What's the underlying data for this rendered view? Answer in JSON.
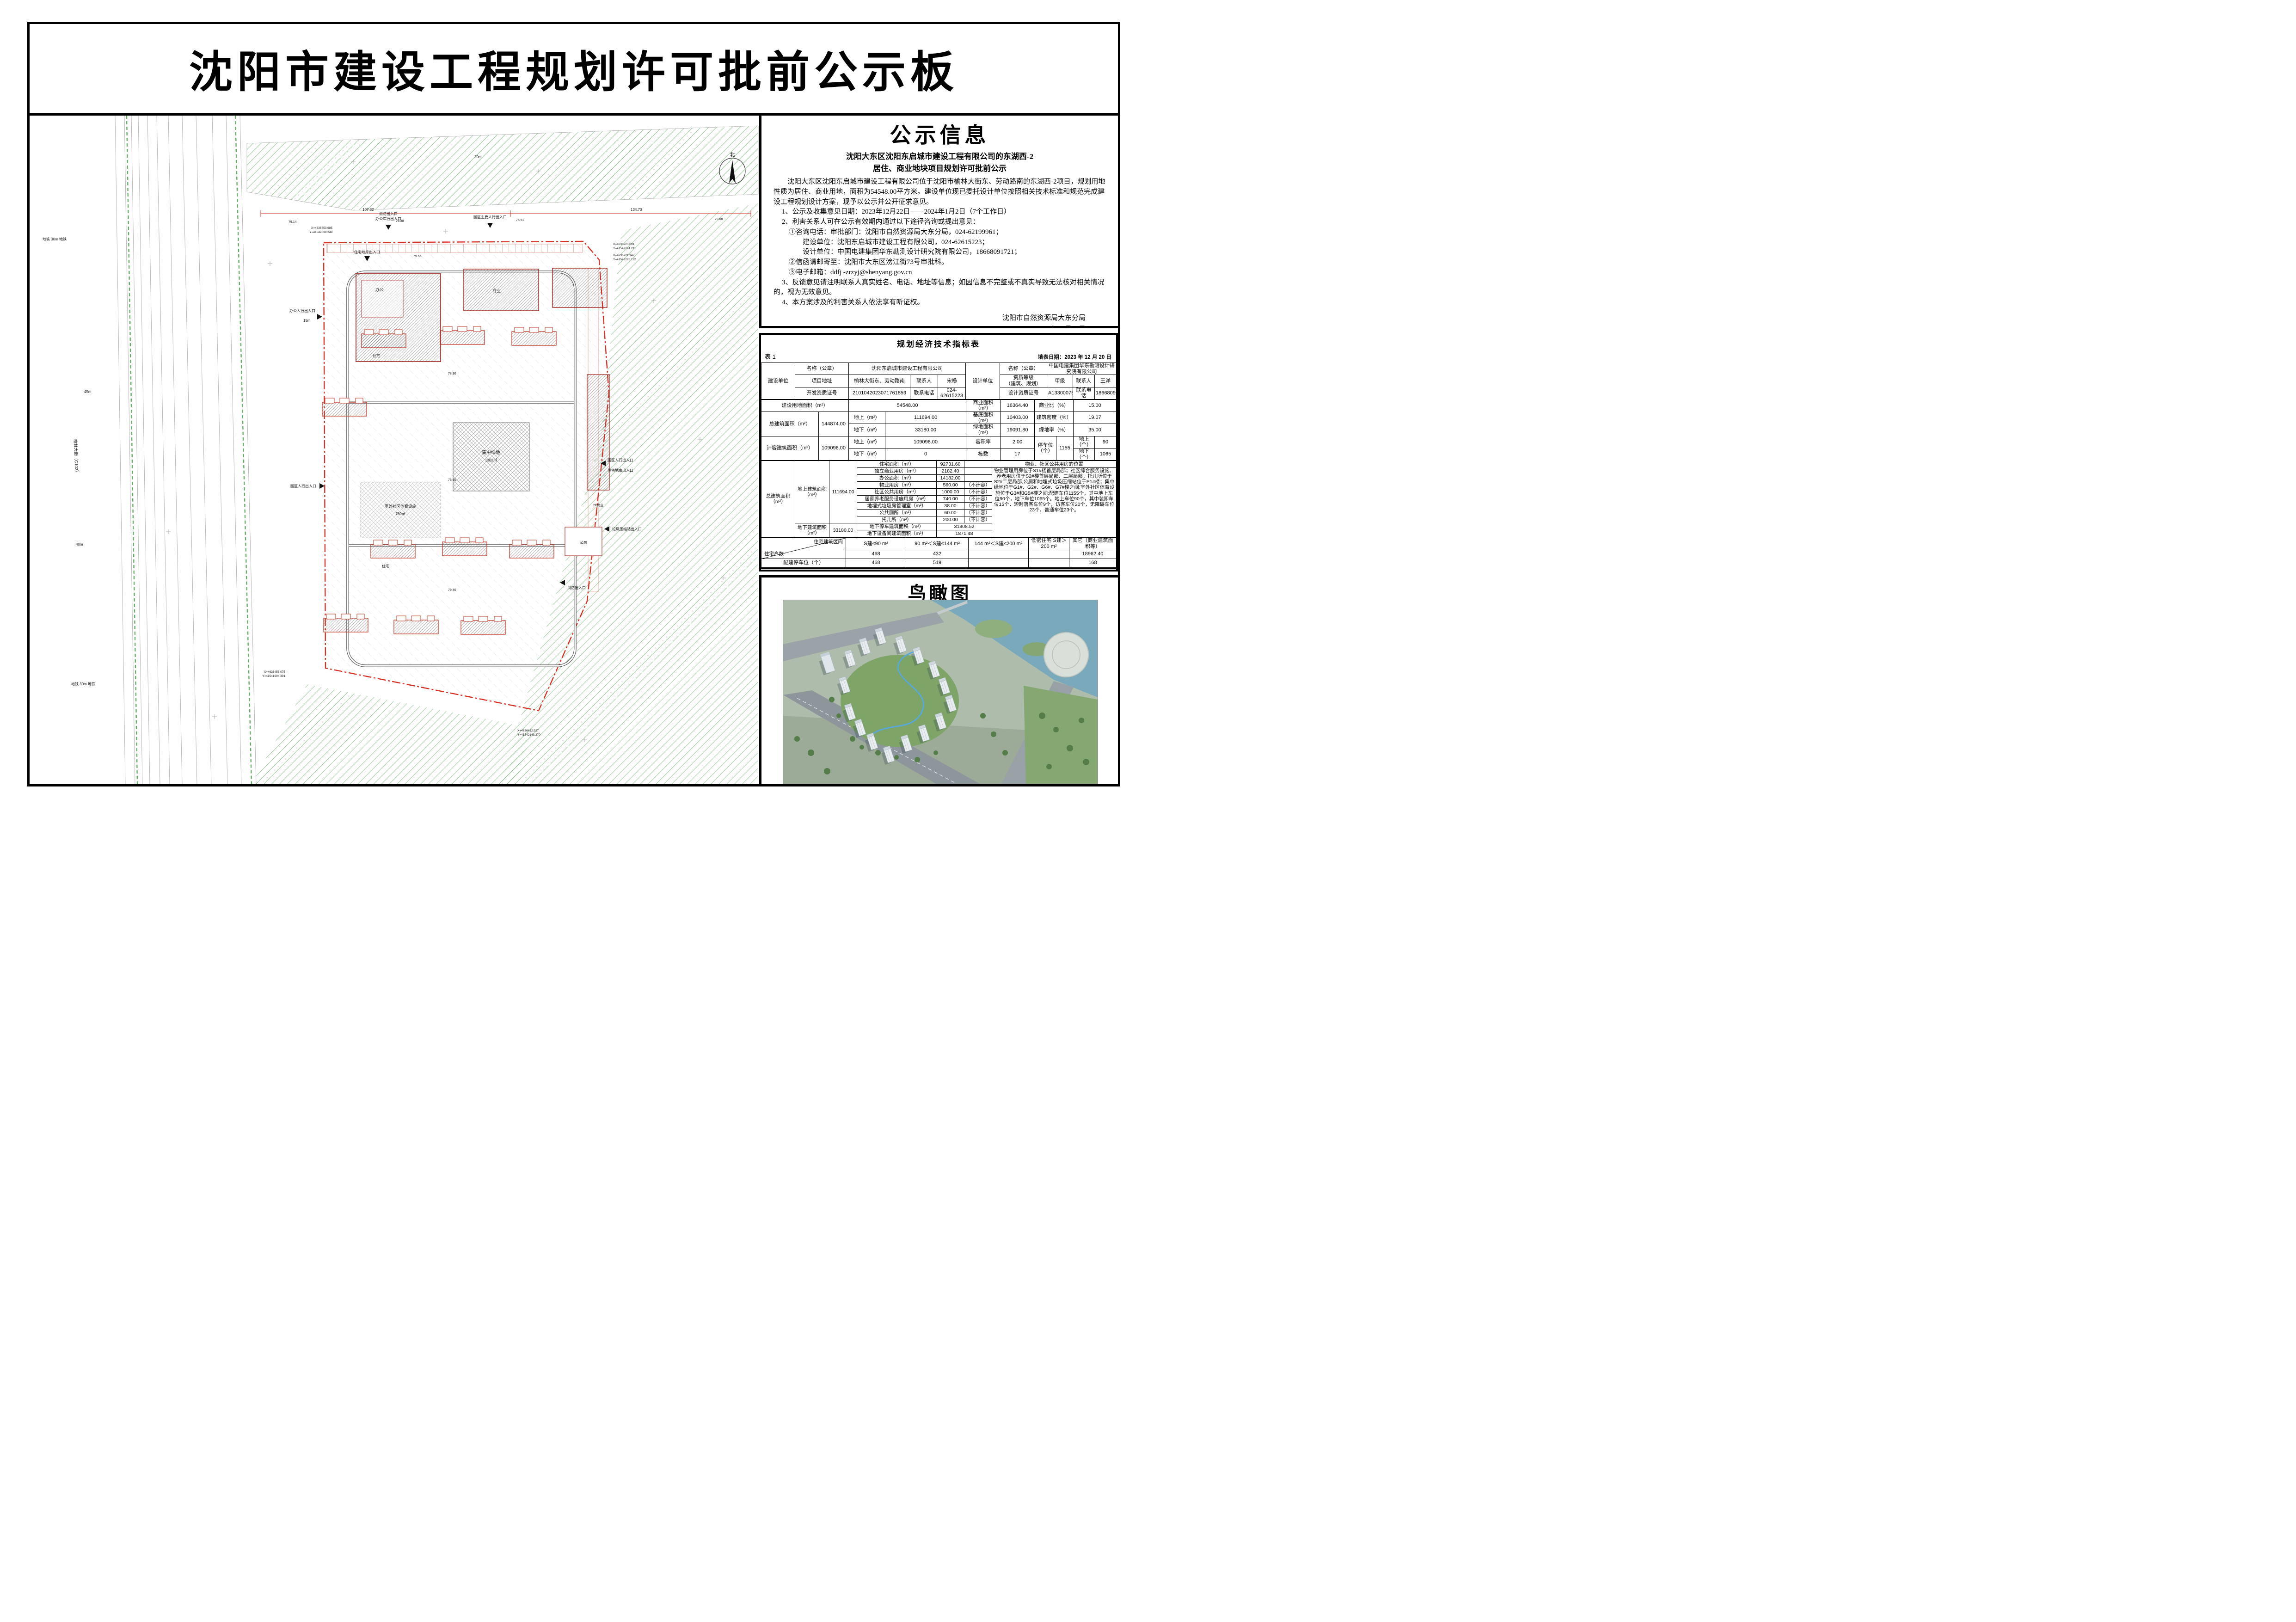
{
  "banner": {
    "title": "沈阳市建设工程规划许可批前公示板"
  },
  "notice": {
    "title": "公示信息",
    "subtitle1": "沈阳大东区沈阳东启城市建设工程有限公司的东湖西-2",
    "subtitle2": "居住、商业地块项目规划许可批前公示",
    "para_intro": "沈阳大东区沈阳东启城市建设工程有限公司位于沈阳市榆林大街东、劳动路南的东湖西-2项目，规划用地性质为居住、商业用地，面积为54548.00平方米。建设单位现已委托设计单位按照相关技术标准和规范完成建设工程规划设计方案，现予以公示并公开征求意见。",
    "item1": "1、公示及收集意见日期：2023年12月22日——2024年1月2日（7个工作日）",
    "item2": "2、利害关系人可在公示有效期内通过以下途径咨询或提出意见：",
    "item2_1": "①咨询电话：审批部门：沈阳市自然资源局大东分局，024-62199961；",
    "item2_1a": "建设单位：沈阳东启城市建设工程有限公司，024-62615223；",
    "item2_1b": "设计单位：中国电建集团华东勘测设计研究院有限公司，18668091721；",
    "item2_2": "②信函请邮寄至：沈阳市大东区滂江街73号审批科。",
    "item2_3": "③电子邮箱：ddfj -zrzyj@shenyang.gov.cn",
    "item3": "3、反馈意见请注明联系人真实姓名、电话、地址等信息；如因信息不完整或不真实导致无法核对相关情况的，视为无效意见。",
    "item4": "4、本方案涉及的利害关系人依法享有听证权。",
    "sign_agency": "沈阳市自然资源局大东分局",
    "sign_date": "2023年12月22日"
  },
  "table": {
    "no": "表 1",
    "title": "规划经济技术指标表",
    "date": "填表日期：2023 年 12 月 20 日",
    "h": {
      "builder": "建设单位",
      "name": "名称（公章）",
      "builder_name": "沈阳东启城市建设工程有限公司",
      "addr_l": "项目地址",
      "addr": "榆林大街东、劳动路南",
      "contact_l": "联系人",
      "builder_contact": "宋畅",
      "devcert_l": "开发资质证号",
      "devcert": "2101042023071761859",
      "phone_l": "联系电话",
      "builder_phone": "024-62615223",
      "designer": "设计单位",
      "name2": "名称（公章）",
      "designer_name": "中国电建集团华东勘测设计研究院有限公司",
      "grade_l1": "资质等级",
      "grade_l2": "（建筑、规划）",
      "grade": "甲级",
      "contact_l2": "联系人",
      "designer_contact": "王洋",
      "designcert_l": "设计资质证号",
      "designcert": "A133000751",
      "phone_l2": "联系电话",
      "designer_phone": "18668091721"
    },
    "m": {
      "land_l": "建设用地面积（m²）",
      "land": "54548.00",
      "biz_area_l": "商业面积（m²）",
      "biz_area": "16364.40",
      "biz_ratio_l": "商业比（%）",
      "biz_ratio": "15.00",
      "total_l": "总建筑面积（m²）",
      "total": "144874.00",
      "above_l": "地上（m²）",
      "above": "111694.00",
      "base_l": "基底面积（m²）",
      "base": "10403.00",
      "density_l": "建筑密度（%）",
      "density": "19.07",
      "below_l": "地下（m²）",
      "below": "33180.00",
      "green_area_l": "绿地面积（m²）",
      "green_area": "19091.80",
      "green_ratio_l": "绿地率（%）",
      "green_ratio": "35.00",
      "cap_l": "计容建筑面积（m²）",
      "cap": "109096.00",
      "cap_above_l": "地上（m²）",
      "cap_above": "109096.00",
      "cap_below_l": "地下（m²）",
      "cap_below": "0",
      "far_l": "容积率",
      "far": "2.00",
      "blocks_l": "栋数",
      "blocks": "17",
      "parking_l": "停车位（个）",
      "parking": "1155",
      "parking_above_l": "地上（个）",
      "parking_above": "90",
      "parking_below_l": "地下（个）",
      "parking_below": "1065"
    },
    "b": {
      "total_l": "总建筑面积（m²）",
      "above_l": "地上建筑面积（m²）",
      "above": "111694.00",
      "below_l": "地下建筑面积（m²）",
      "below": "33180.00",
      "items": [
        {
          "l": "住宅面积（m²）",
          "v": "92731.60",
          "n": ""
        },
        {
          "l": "独立商业用房（m²）",
          "v": "2182.40",
          "n": ""
        },
        {
          "l": "办公面积（m²）",
          "v": "14182.00",
          "n": ""
        },
        {
          "l": "物业用房（m²）",
          "v": "560.00",
          "n": "（不计容）"
        },
        {
          "l": "社区公共用房（m²）",
          "v": "1000.00",
          "n": "（不计容）"
        },
        {
          "l": "居家养老服务设施用房（m²）",
          "v": "740.00",
          "n": "（不计容）"
        },
        {
          "l": "地埋式垃圾房管理室（m²）",
          "v": "38.00",
          "n": "（不计容）"
        },
        {
          "l": "公共厕所（m²）",
          "v": "60.00",
          "n": "（不计容）"
        },
        {
          "l": "托儿所（m²）",
          "v": "200.00",
          "n": "（不计容）"
        }
      ],
      "ug_parking_l": "地下停车建筑面积（m²）",
      "ug_parking": "31308.52",
      "ug_equip_l": "地下设备间建筑面积（m²）",
      "ug_equip": "1871.48",
      "note_title": "物业、社区公共用房的位置",
      "note": "物业管理用房位于S1#楼首层局部；社区综合服务设施、养老用房位于S2#楼首层局部、二层局部；托儿所位于S2#二层局部,公厕和地埋式垃圾压缩站位于P1#楼；集中绿地位于G1#、G2#、G6#、G7#楼之间;室外社区体育设施位于G3#和G5#楼之间;配建车位1155个，其中地上车位90个，地下车位1065个。地上车位90个，其中装卸车位15个，短时落客车位9个，访客车位20个，无障碍车位23个，普通车位23个。"
    },
    "r": {
      "range_l": "住宅建筑区间",
      "households_l": "住宅户数",
      "parking_l": "配建停车位（个）",
      "c1": "S建≤90 m²",
      "c2": "90 m²＜S建≤144 m²",
      "c3": "144 m²＜S建≤200 m²",
      "c4": "低密住宅 S建＞200 m²",
      "c5": "其它（商业建筑面积等）",
      "hh1": "468",
      "hh2": "432",
      "hh3": "",
      "hh4": "",
      "hh5": "18962.40",
      "pk1": "468",
      "pk2": "519",
      "pk3": "",
      "pk4": "",
      "pk5": "168"
    },
    "remark": "备注：我司承诺建筑面积计算方式及各项指标计算方法符合国家现行标准规定及标准《建筑工程建筑面积计算规范》(GB/T50353-2013)、《关于修订〈辽宁省住宅与共建用地容积率计算管理规定〉的通知》〈辽住建[2015]94号〉；物业用房、社区用房面积指标计算方式按照《沈阳市居住配套公共服务设施管理办法》的规定；车位计算方式符合《沈阳市建筑物机动车停车位配建标准规定〈试行〉》的规定，如有不符后果自负"
  },
  "birdview": {
    "title": "鸟瞰图"
  },
  "siteplan": {
    "north": "北",
    "street": "榆林大街（G102）",
    "metro_top": "地铁 30m 地铁",
    "metro_bottom": "地铁 30m 地铁",
    "ent_fire_top": "消防出入口",
    "ent_office_vehicle": "办公车行出入口",
    "ent_main_ped": "园区主要人行出入口",
    "ent_office_ped": "办公人行出入口",
    "ent_res_garage": "住宅地库出入口",
    "ent_garbage": "垃圾压缩站出入口",
    "ent_fire_right": "消防出入口",
    "ent_park_ped_left": "园区人行出入口",
    "ent_park_ped_right": "园区人行出入口",
    "ent_res_garage_right": "住宅地库出入口",
    "central_green": "集中绿地",
    "central_green_area": "1302㎡",
    "sports": "室外社区体育设施",
    "sports_area": "780㎡",
    "office_label": "办公",
    "commercial_label": "商业",
    "residential_label": "住宅",
    "residential_label2": "住宅",
    "toilet_label": "公厕",
    "biz2f_label": "2F商业",
    "coord1x": "X=4636753.985",
    "coord1y": "Y=41542039.249",
    "coord2x": "X=4636723.091",
    "coord2y": "Y=41542224.211",
    "coord3x": "X=4636721.947",
    "coord3y": "Y=41542225.112",
    "coord4x": "X=4636458.075",
    "coord4y": "Y=41541994.391",
    "coord5x": "X=4636412.927",
    "coord5y": "Y=41542143.370",
    "dim1": "107.32",
    "dim2": "134.70",
    "dim3": "45m",
    "dim4": "40m",
    "dim5": "15m",
    "dim6": "20m",
    "el1": "79.14",
    "el2": "79.38",
    "el3": "75.51",
    "el4": "79.00",
    "el5": "79.55",
    "el6": "78.60",
    "el7": "78.90",
    "el8": "79.40"
  }
}
